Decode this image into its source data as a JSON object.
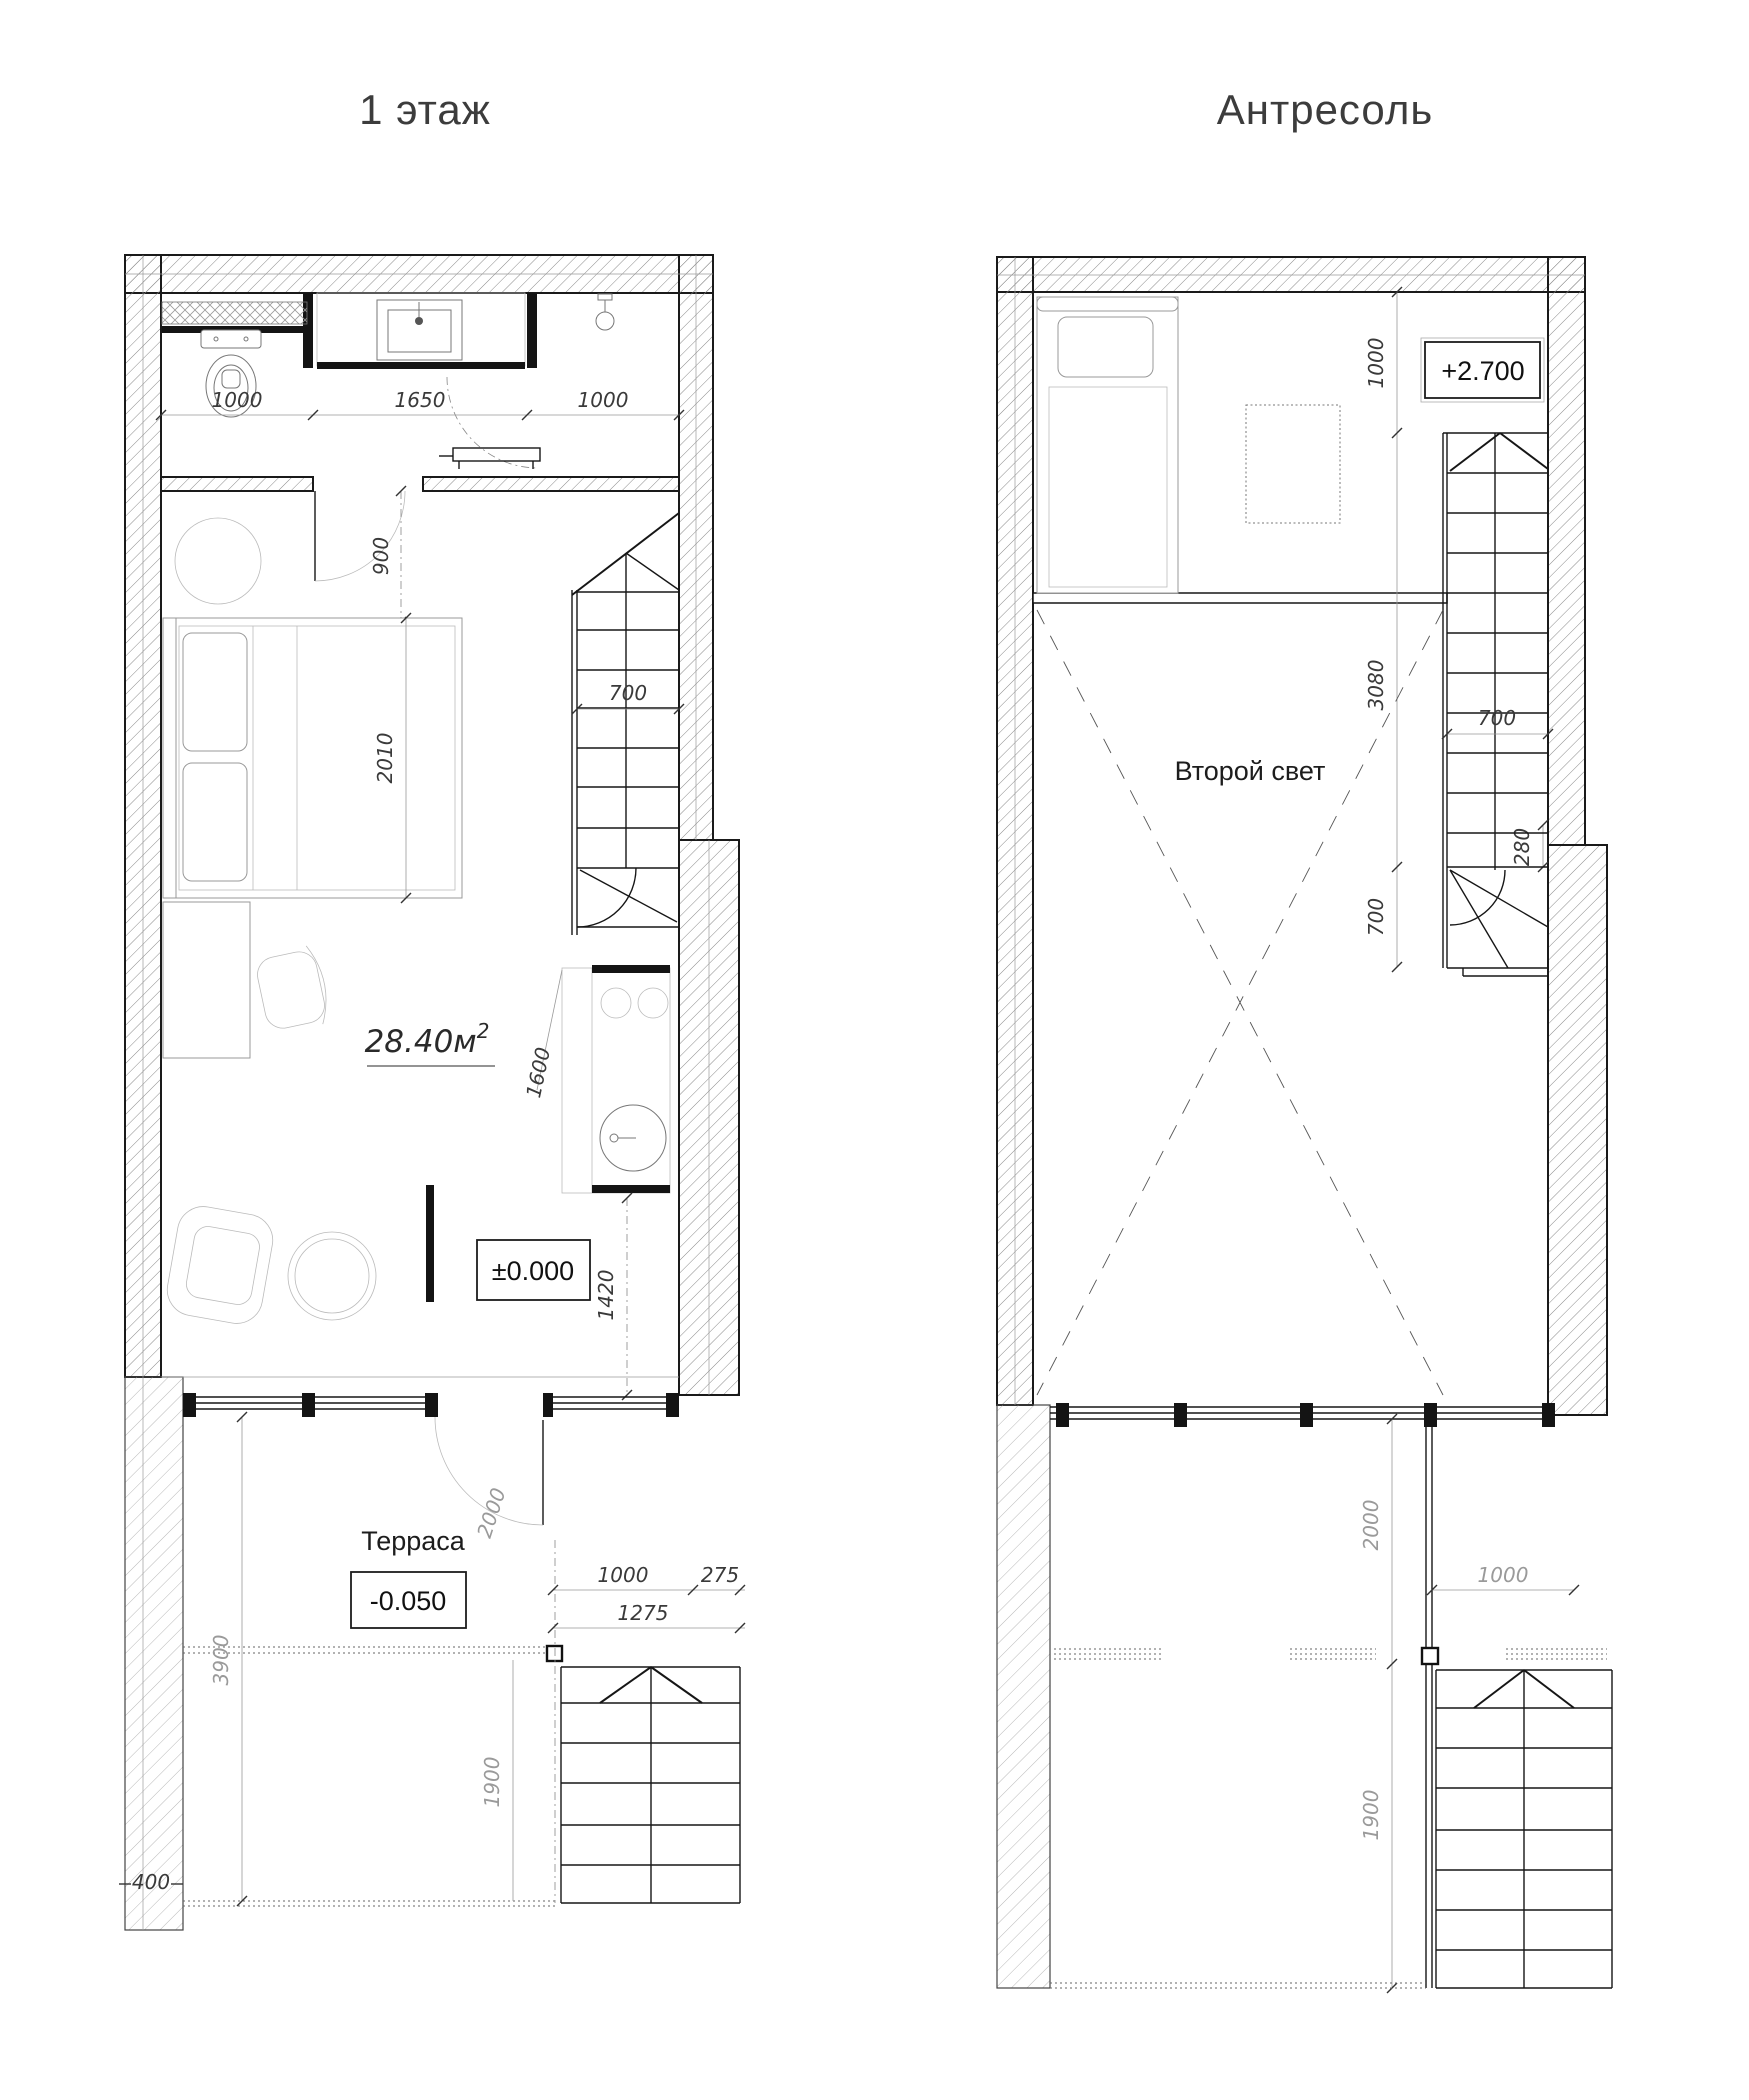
{
  "colors": {
    "background": "#ffffff",
    "wall_line": "#1a1a1a",
    "hatch": "#8a8a8a",
    "dim_text": "#3a3a3a",
    "dim_text_light": "#9a9a9a"
  },
  "floor1": {
    "title": "1 этаж",
    "area_value": "28.40м",
    "area_sup": "2",
    "terrace_label": "Терраса",
    "level_zero": "±0.000",
    "level_terrace": "-0.050",
    "dim_wc_width": "1000",
    "dim_vanity_width": "1650",
    "dim_shower_width": "1000",
    "dim_bath_door": "900",
    "dim_bed_length": "2010",
    "dim_stair_width": "700",
    "dim_kitchen_width": "1600",
    "dim_hall_depth": "1420",
    "dim_terrace_door": "2000",
    "dim_terrace_depth": "3900",
    "dim_porch_width": "1000",
    "dim_porch_edge": "275",
    "dim_porch_total": "1275",
    "dim_porch_depth": "1900",
    "dim_wall_offset": "400"
  },
  "mezzanine": {
    "title": "Антресоль",
    "void_label": "Второй свет",
    "level_floor": "+2.700",
    "dim_landing": "1000",
    "dim_void_length": "3080",
    "dim_stair_width": "700",
    "dim_tread_zone": "280",
    "dim_winder": "700",
    "dim_terrace_door": "2000",
    "dim_porch_width": "1000",
    "dim_porch_depth": "1900"
  }
}
